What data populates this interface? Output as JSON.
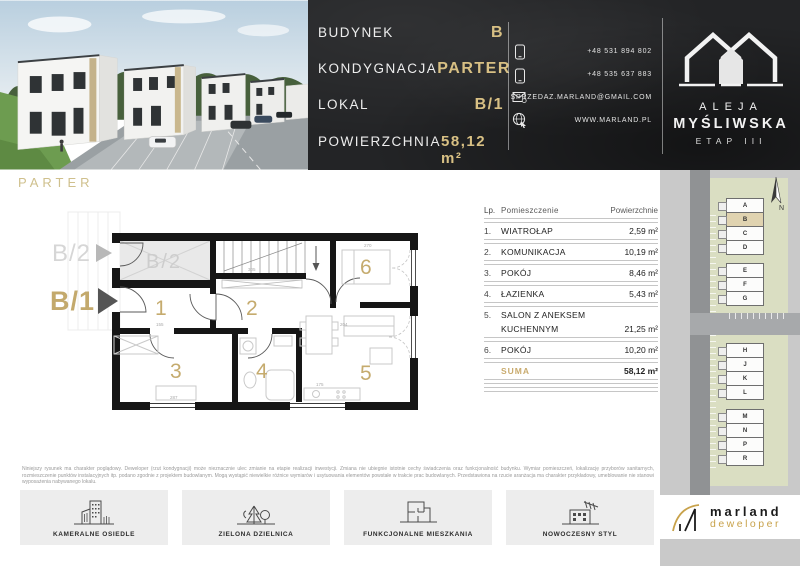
{
  "header": {
    "info": [
      {
        "label": "BUDYNEK",
        "value": "B"
      },
      {
        "label": "KONDYGNACJA",
        "value": "PARTER"
      },
      {
        "label": "LOKAL",
        "value": "B/1"
      },
      {
        "label": "POWIERZCHNIA",
        "value": "58,12 m²"
      }
    ],
    "contact": {
      "phone1": "+48 531 894 802",
      "phone2": "+48 535 637 883",
      "email": "SPRZEDAZ.MARLAND@GMAIL.COM",
      "website": "WWW.MARLAND.PL"
    },
    "estate_logo": {
      "line1": "ALEJA",
      "line2": "MYŚLIWSKA",
      "line3": "ETAP III"
    }
  },
  "floor_label": "PARTER",
  "plan": {
    "unit_label": "B/1",
    "adjacent_label": "B/2",
    "rooms": [
      "1",
      "2",
      "3",
      "4",
      "5",
      "6"
    ],
    "dims": [
      "155",
      "305",
      "204",
      "270",
      "287",
      "175"
    ]
  },
  "rooms_table": {
    "headers": {
      "no": "Lp.",
      "name": "Pomieszczenie",
      "area": "Powierzchnie"
    },
    "rows": [
      {
        "no": "1.",
        "name": "WIATROŁAP",
        "area": "2,59 m²"
      },
      {
        "no": "2.",
        "name": "KOMUNIKACJA",
        "area": "10,19 m²"
      },
      {
        "no": "3.",
        "name": "POKÓJ",
        "area": "8,46 m²"
      },
      {
        "no": "4.",
        "name": "ŁAZIENKA",
        "area": "5,43 m²"
      },
      {
        "no": "5.",
        "name": "SALON Z ANEKSEM",
        "name2": "KUCHENNYM",
        "area": "21,25 m²"
      },
      {
        "no": "6.",
        "name": "POKÓJ",
        "area": "10,20 m²"
      }
    ],
    "total": {
      "label": "SUMA",
      "area": "58,12 m²"
    }
  },
  "site_plan": {
    "north_label": "N",
    "letters": [
      "A",
      "B",
      "C",
      "D",
      "E",
      "F",
      "G",
      "H",
      "J",
      "K",
      "L",
      "M",
      "N",
      "P",
      "R"
    ],
    "highlighted": "B"
  },
  "disclaimer": "Niniejszy rysunek ma charakter poglądowy. Deweloper (rzut kondygnacji) może nieznacznie ulec zmianie na etapie realizacji inwestycji. Zmiana nie ubiegnie istotnie cechy świadczenia oraz funkcjonalność budynku. Wymiar pomieszczeń, lokalizację przyborów sanitarnych, rozmieszczenie punktów instalacyjnych itp. podano zgodnie z projektem budowlanym. Mogą wystąpić niewielkie różnice wymiarów i usytuowania elementów powstałe w trakcie prac budowlanych. Przedstawiona na rzucie aranżacja ma charakter przykładowy, umeblowanie nie stanowi wyposażenia nabywanego lokalu.",
  "features": [
    {
      "label": "KAMERALNE OSIEDLE"
    },
    {
      "label": "ZIELONA DZIELNICA"
    },
    {
      "label": "FUNKCJONALNE MIESZKANIA"
    },
    {
      "label": "NOWOCZESNY STYL"
    }
  ],
  "developer": {
    "name": "marland",
    "subtitle": "deweloper"
  },
  "colors": {
    "gold": "#c9ab6e",
    "dark": "#232426",
    "sidebar_gray": "#c9c9c9",
    "site_olive": "#dadec2",
    "highlight_beige": "#e0d3b0"
  }
}
